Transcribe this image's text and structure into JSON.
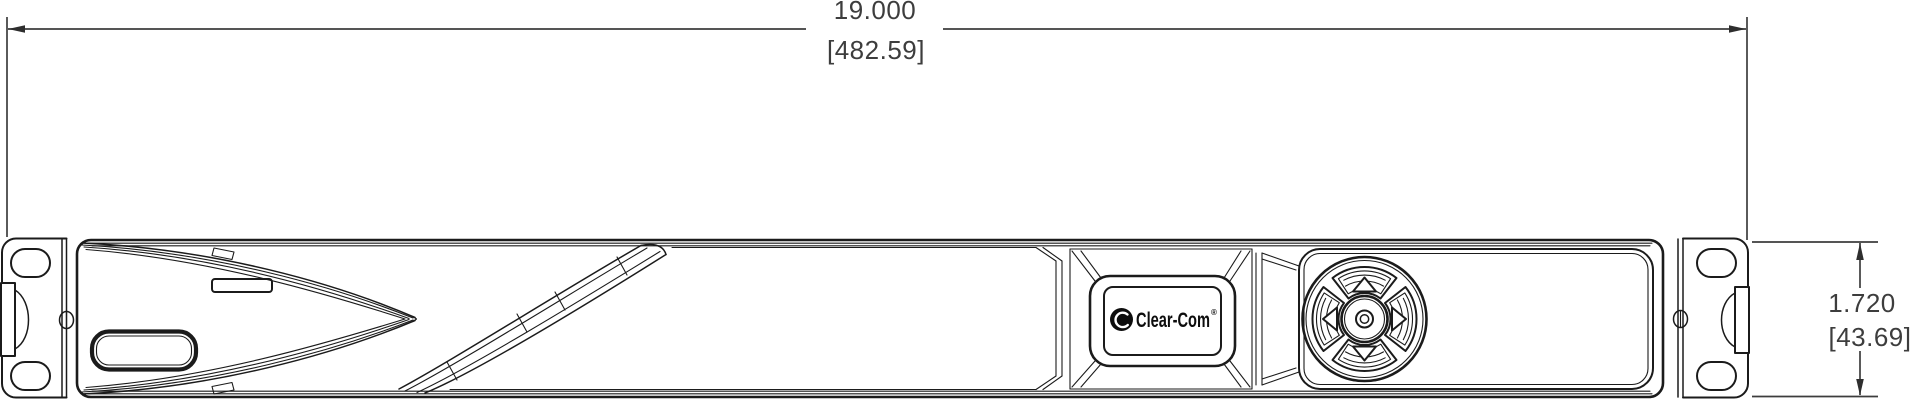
{
  "dimensions": {
    "width": {
      "inches": "19.000",
      "millimeters": "[482.59]"
    },
    "height": {
      "inches": "1.720",
      "millimeters": "[43.69]"
    }
  },
  "badge": {
    "brand": "Clear-Com",
    "registered_mark": "®"
  },
  "colors": {
    "line": "#1b1b1b",
    "dimension_text": "#3d3d3d",
    "background": "#ffffff",
    "logo": "#0d0d0d"
  }
}
